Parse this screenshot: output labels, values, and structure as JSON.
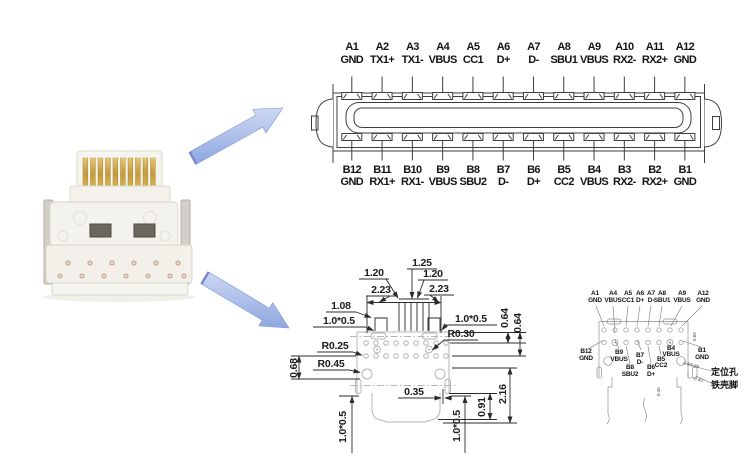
{
  "colors": {
    "arrow_fill": "#9db4e6",
    "arrow_edge": "#7f97d6",
    "drawing_line": "#3f3f3f",
    "dim_line": "#2b2b2b",
    "footprint_line": "#b5b5b5",
    "gold": "#c9a64a",
    "connector_body": "#f4f2ec"
  },
  "pinout": {
    "row_a": [
      {
        "pin": "A1",
        "signal": "GND"
      },
      {
        "pin": "A2",
        "signal": "TX1+"
      },
      {
        "pin": "A3",
        "signal": "TX1-"
      },
      {
        "pin": "A4",
        "signal": "VBUS"
      },
      {
        "pin": "A5",
        "signal": "CC1"
      },
      {
        "pin": "A6",
        "signal": "D+"
      },
      {
        "pin": "A7",
        "signal": "D-"
      },
      {
        "pin": "A8",
        "signal": "SBU1"
      },
      {
        "pin": "A9",
        "signal": "VBUS"
      },
      {
        "pin": "A10",
        "signal": "RX2-"
      },
      {
        "pin": "A11",
        "signal": "RX2+"
      },
      {
        "pin": "A12",
        "signal": "GND"
      }
    ],
    "row_b": [
      {
        "pin": "B12",
        "signal": "GND"
      },
      {
        "pin": "B11",
        "signal": "RX1+"
      },
      {
        "pin": "B10",
        "signal": "RX1-"
      },
      {
        "pin": "B9",
        "signal": "VBUS"
      },
      {
        "pin": "B8",
        "signal": "SBU2"
      },
      {
        "pin": "B7",
        "signal": "D-"
      },
      {
        "pin": "B6",
        "signal": "D+"
      },
      {
        "pin": "B5",
        "signal": "CC2"
      },
      {
        "pin": "B4",
        "signal": "VBUS"
      },
      {
        "pin": "B3",
        "signal": "RX2-"
      },
      {
        "pin": "B2",
        "signal": "RX2+"
      },
      {
        "pin": "B1",
        "signal": "GND"
      }
    ]
  },
  "dimensions": [
    {
      "id": "pitch_a",
      "text": "1.25"
    },
    {
      "id": "pitch_b",
      "text": "1.20"
    },
    {
      "id": "pitch_c",
      "text": "1.20"
    },
    {
      "id": "span_a",
      "text": "2.23"
    },
    {
      "id": "span_b",
      "text": "2.23"
    },
    {
      "id": "tab_offset",
      "text": "1.08"
    },
    {
      "id": "pad_tl",
      "text": "1.0*0.5"
    },
    {
      "id": "pad_tr",
      "text": "1.0*0.5"
    },
    {
      "id": "row_gap_a",
      "text": "0.64"
    },
    {
      "id": "row_gap_b",
      "text": "0.64"
    },
    {
      "id": "r_hole",
      "text": "R0.30"
    },
    {
      "id": "r_pin",
      "text": "R0.25"
    },
    {
      "id": "r_locate",
      "text": "R0.45"
    },
    {
      "id": "edge_off",
      "text": "0.68"
    },
    {
      "id": "slot_w",
      "text": "0.35"
    },
    {
      "id": "pad_bl",
      "text": "1.0*0.5"
    },
    {
      "id": "pad_br",
      "text": "1.0*0.5"
    },
    {
      "id": "body_h",
      "text": "0.91"
    },
    {
      "id": "total_h",
      "text": "2.16"
    }
  ],
  "footprint": {
    "row_a": [
      {
        "pin": "A1",
        "signal": "GND"
      },
      {
        "pin": "A4",
        "signal": "VBUS"
      },
      {
        "pin": "A5",
        "signal": "CC1"
      },
      {
        "pin": "A6",
        "signal": "D+"
      },
      {
        "pin": "A7",
        "signal": "D-"
      },
      {
        "pin": "A8",
        "signal": "SBU1"
      },
      {
        "pin": "A9",
        "signal": "VBUS"
      },
      {
        "pin": "A12",
        "signal": "GND"
      }
    ],
    "row_b": [
      {
        "pin": "B12",
        "signal": "GND"
      },
      {
        "pin": "B9",
        "signal": "VBUS"
      },
      {
        "pin": "B8",
        "signal": "SBU2"
      },
      {
        "pin": "B7",
        "signal": "D-"
      },
      {
        "pin": "B6",
        "signal": "D+"
      },
      {
        "pin": "B5",
        "signal": "CC2"
      },
      {
        "pin": "B4",
        "signal": "VBUS"
      },
      {
        "pin": "B1",
        "signal": "GND"
      }
    ],
    "annotations": [
      {
        "id": "positioning_hole",
        "text": "定位孔"
      },
      {
        "id": "shell_foot",
        "text": "铁壳脚"
      }
    ],
    "small_dims": [
      {
        "id": "hole_dia",
        "text": "2-Φ0.80"
      },
      {
        "id": "foot_w",
        "text": "0.40"
      },
      {
        "id": "edge_r",
        "text": "0.60"
      },
      {
        "id": "side_h",
        "text": "0.45"
      }
    ]
  }
}
